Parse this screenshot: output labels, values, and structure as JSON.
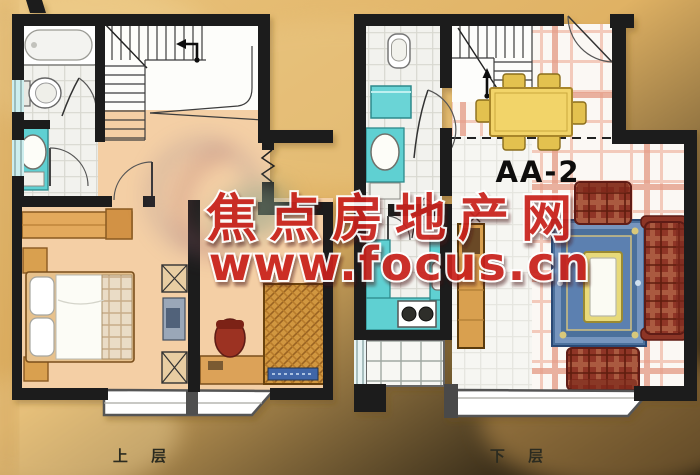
{
  "watermark": {
    "line1": "焦点房地产网",
    "line2": "www.focus.cn",
    "color": "#c9241a"
  },
  "plans": {
    "upper": {
      "label": "上 层",
      "rooms": [
        "bathroom",
        "staircase",
        "void",
        "hall",
        "bedroom",
        "study",
        "window-bay"
      ],
      "fixtures": [
        "bathtub",
        "toilet",
        "vanity-sink",
        "stairs-arrow",
        "wardrobe",
        "nightstands",
        "double-bed",
        "computer-desk",
        "desk",
        "chair",
        "rattan-bed"
      ]
    },
    "lower": {
      "label": "下 层",
      "unit": "AA-2",
      "rooms": [
        "toilet-room",
        "laundry",
        "washroom",
        "kitchen",
        "staircase",
        "entry",
        "dining",
        "living-room",
        "balcony",
        "window-bay"
      ],
      "fixtures": [
        "wall-hung-toilet",
        "washing-machine",
        "vanity-sink",
        "kitchen-counter",
        "kitchen-sink",
        "stove",
        "dining-table",
        "dining-chairs",
        "tall-cabinet",
        "rug",
        "coffee-table",
        "sofa",
        "armchairs",
        "entry-door"
      ]
    }
  },
  "colors": {
    "background": "#e3ba6e",
    "wall": "#1a1a1a",
    "fixture_teal": "#5fd0d2",
    "floor_peach": "#f4cfa5",
    "wood": "#dca258",
    "sofa_red": "#8f3526",
    "rug_blue": "#4c6f9c",
    "table_yellow": "#f2d469",
    "tile_pink": "#f3cabb"
  }
}
